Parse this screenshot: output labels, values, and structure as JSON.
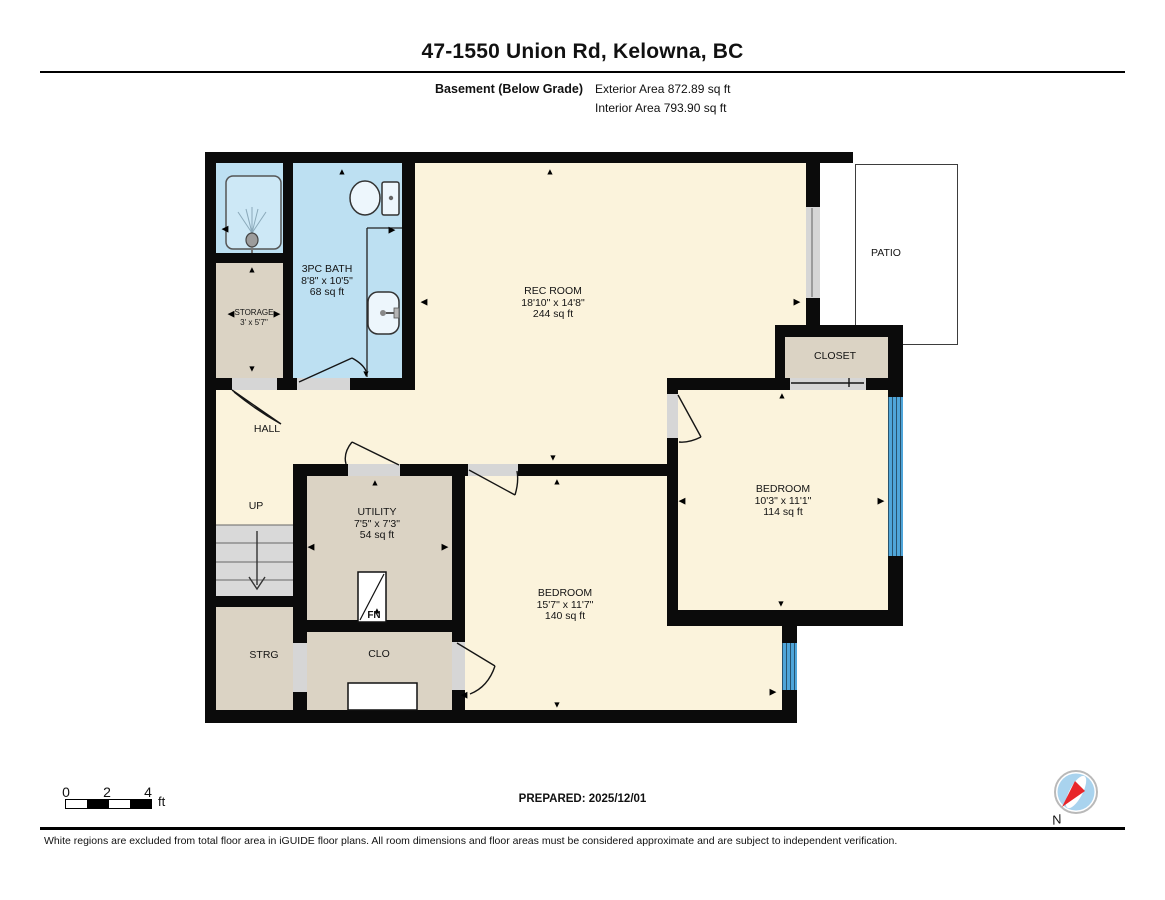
{
  "header": {
    "title": "47-1550 Union Rd, Kelowna, BC",
    "floor_label": "Basement (Below Grade)",
    "exterior_area": "Exterior Area 872.89 sq ft",
    "interior_area": "Interior Area 793.90 sq ft"
  },
  "rooms": {
    "bath": {
      "name": "3PC BATH",
      "dims": "8'8\" x 10'5\"",
      "area": "68 sq ft"
    },
    "storage": {
      "name": "STORAGE",
      "dims": "3' x 5'7\""
    },
    "rec_room": {
      "name": "REC ROOM",
      "dims": "18'10\" x 14'8\"",
      "area": "244 sq ft"
    },
    "patio": {
      "name": "PATIO"
    },
    "closet": {
      "name": "CLOSET"
    },
    "bedroom_right": {
      "name": "BEDROOM",
      "dims": "10'3\" x 11'1\"",
      "area": "114 sq ft"
    },
    "hall": {
      "name": "HALL"
    },
    "up": {
      "name": "UP"
    },
    "utility": {
      "name": "UTILITY",
      "dims": "7'5\" x 7'3\"",
      "area": "54 sq ft"
    },
    "furnace": {
      "name": "FN"
    },
    "strg": {
      "name": "STRG"
    },
    "clo": {
      "name": "CLO"
    },
    "bedroom_bottom": {
      "name": "BEDROOM",
      "dims": "15'7\" x 11'7\"",
      "area": "140 sq ft"
    }
  },
  "plan": {
    "arrows": [
      {
        "d": "up",
        "x": 342,
        "y": 172
      },
      {
        "d": "up",
        "x": 550,
        "y": 172
      },
      {
        "d": "up",
        "x": 252,
        "y": 270
      },
      {
        "d": "up",
        "x": 782,
        "y": 396
      },
      {
        "d": "up",
        "x": 557,
        "y": 482
      },
      {
        "d": "up",
        "x": 375,
        "y": 483
      },
      {
        "d": "up",
        "x": 377,
        "y": 611
      },
      {
        "d": "down",
        "x": 252,
        "y": 369
      },
      {
        "d": "down",
        "x": 553,
        "y": 458
      },
      {
        "d": "down",
        "x": 366,
        "y": 374
      },
      {
        "d": "down",
        "x": 781,
        "y": 604
      },
      {
        "d": "down",
        "x": 557,
        "y": 705
      },
      {
        "d": "left",
        "x": 231,
        "y": 314
      },
      {
        "d": "left",
        "x": 424,
        "y": 302
      },
      {
        "d": "left",
        "x": 682,
        "y": 501
      },
      {
        "d": "left",
        "x": 311,
        "y": 547
      },
      {
        "d": "left",
        "x": 464,
        "y": 695
      },
      {
        "d": "left",
        "x": 225,
        "y": 229
      },
      {
        "d": "right",
        "x": 277,
        "y": 314
      },
      {
        "d": "right",
        "x": 392,
        "y": 230
      },
      {
        "d": "right",
        "x": 797,
        "y": 302
      },
      {
        "d": "right",
        "x": 881,
        "y": 501
      },
      {
        "d": "right",
        "x": 445,
        "y": 547
      },
      {
        "d": "right",
        "x": 773,
        "y": 692
      }
    ]
  },
  "footer": {
    "prepared": "PREPARED: 2025/12/01",
    "scale": {
      "t0": "0",
      "t2": "2",
      "t4": "4",
      "unit": "ft"
    },
    "compass_label": "N",
    "disclaimer": "White regions are excluded from total floor area in iGUIDE floor plans. All room dimensions and floor areas must be considered approximate and are subject to independent verification."
  },
  "colors": {
    "wall": "#0b0b0b",
    "floor_cream": "#FBF3DC",
    "floor_tan": "#DBD3C4",
    "floor_bath_blue": "#BDE0F2",
    "window_blue": "#4FA5D9",
    "door_gray": "#D6D6D6",
    "stairs_gray": "#D9D9D9",
    "compass_red": "#E03A3A",
    "compass_blue": "#A9D3EE"
  }
}
